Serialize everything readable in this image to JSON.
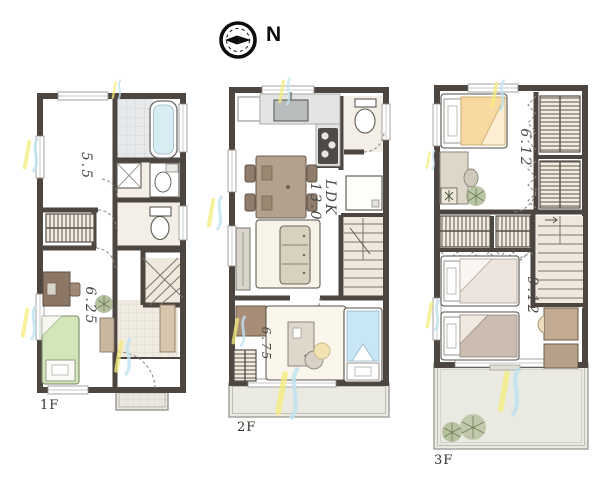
{
  "compass": {
    "north_label": "N"
  },
  "floors": {
    "f1": {
      "label": "1F",
      "rooms": {
        "main": "5.5",
        "bedroom": "6.25"
      }
    },
    "f2": {
      "label": "2F",
      "rooms": {
        "ldk_name": "LDK",
        "ldk_size": "13.0",
        "bedroom": "6.75"
      }
    },
    "f3": {
      "label": "3F",
      "rooms": {
        "bedroom_top": "6.12",
        "bedroom_bottom": "9.12"
      }
    }
  },
  "colors": {
    "wall": "#4d453f",
    "wood_floor": "#f6ecdd",
    "tile_floor": "#e7e9ea",
    "balcony_floor": "#ebeae2",
    "tub_water": "#d7edf3",
    "bed_green": "#d3e6ba",
    "bed_blue": "#c9e6f7",
    "bed_orange": "#f8d9a2",
    "bed_gray": "#cbbeb1",
    "sofa": "#d6d2bd",
    "table_brown": "#b3a18d",
    "desk_brown": "#8c7767",
    "accent_yellow": "#f4ec7c",
    "accent_blue": "#bfe2f1",
    "plant_green": "#8ea06f"
  }
}
